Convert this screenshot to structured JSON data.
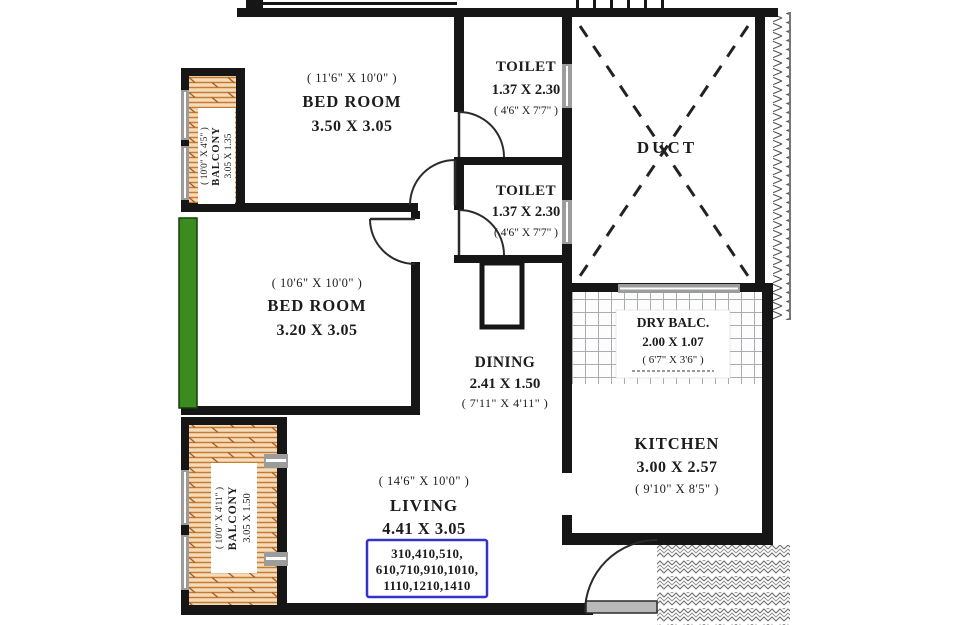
{
  "drawing": {
    "type": "apartment floor plan"
  },
  "colors": {
    "wall": "#161616",
    "balcony_wood_bg": "#f4dcba",
    "balcony_wood_line": "#c97a31",
    "green_window_strip": "#3c8b1f",
    "blue_stamp": "#3434c9",
    "window_gray": "#9c9c9c"
  },
  "rooms": {
    "bedroom1": {
      "feet": "( 11'6\" X 10'0\" )",
      "name": "BED ROOM",
      "metric": "3.50 X 3.05"
    },
    "bedroom2": {
      "feet": "( 10'6\" X 10'0\" )",
      "name": "BED ROOM",
      "metric": "3.20 X 3.05"
    },
    "toilet1": {
      "name": "TOILET",
      "metric": "1.37 X 2.30",
      "feet": "( 4'6\" X 7'7\" )"
    },
    "toilet2": {
      "name": "TOILET",
      "metric": "1.37 X 2.30",
      "feet": "( 4'6\" X 7'7\" )"
    },
    "duct": {
      "name": "DUCT"
    },
    "dining": {
      "name": "DINING",
      "metric": "2.41 X 1.50",
      "feet": "( 7'11\" X 4'11\" )"
    },
    "dry_balcony": {
      "name": "DRY BALC.",
      "metric": "2.00 X 1.07",
      "feet": "( 6'7\" X 3'6\" )"
    },
    "kitchen": {
      "name": "KITCHEN",
      "metric": "3.00 X 2.57",
      "feet": "( 9'10\" X 8'5\" )"
    },
    "living": {
      "feet": "( 14'6\" X 10'0\" )",
      "name": "LIVING",
      "metric": "4.41 X 3.05"
    },
    "balcony_top": {
      "feet": "( 10'0\" X 4'5\" )",
      "name": "BALCONY",
      "metric": "3.05 X 1.35"
    },
    "balcony_bottom": {
      "feet": "( 10'0\" X 4'11\" )",
      "name": "BALCONY",
      "metric": "3.05 X 1.50"
    }
  },
  "flat_numbers": {
    "line1": "310,410,510,",
    "line2": "610,710,910,1010,",
    "line3": "1110,1210,1410"
  }
}
